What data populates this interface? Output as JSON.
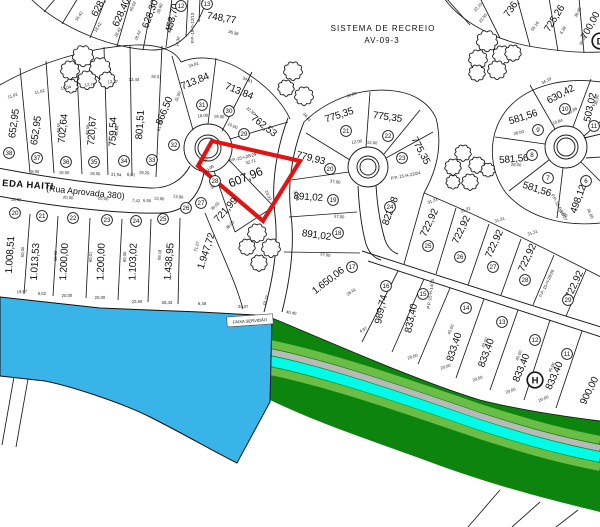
{
  "map": {
    "title": "Planta de loteamento (cadastral plat)",
    "colors": {
      "water": "#39b4e8",
      "band_dark": "#0d840d",
      "band_light": "#6abe45",
      "band_gray": "#b9b9b9",
      "band_cyan": "#00fce8",
      "highlight": "#e11414",
      "line": "#1a1a1a"
    },
    "annotations": {
      "recreation_line1": "SISTEMA DE RECREIO",
      "recreation_line2": "AV-09-3",
      "servidao_label": "FAIXA SERVIDÃO",
      "street_name": "EDA HAITI",
      "street_suffix": "(Rua Aprovada 380)"
    },
    "highlight": {
      "lot_number": "28",
      "lot_area": "607,96",
      "points": "212,141 300,161 263,221 198,166"
    },
    "area_labels": [
      [
        "628,",
        101,
        9,
        -62,
        10
      ],
      [
        "628,40",
        124,
        14,
        -66,
        10
      ],
      [
        "628,30",
        153,
        15,
        -70,
        10
      ],
      [
        "453,70",
        175,
        19,
        -76,
        10
      ],
      [
        "748,77",
        221,
        21,
        10,
        10
      ],
      [
        "736,",
        514,
        10,
        -55,
        10
      ],
      [
        "725,26",
        557,
        20,
        -58,
        10
      ],
      [
        "700,00",
        593,
        27,
        -62,
        10
      ],
      [
        "652,95",
        17,
        124,
        -82,
        10
      ],
      [
        "652,95",
        39,
        131,
        -82,
        10
      ],
      [
        "702,64",
        66,
        129,
        -84,
        10
      ],
      [
        "720,67",
        95,
        131,
        -86,
        10
      ],
      [
        "759,54",
        116,
        132,
        -88,
        10
      ],
      [
        "801,51",
        143,
        125,
        -86,
        10
      ],
      [
        "866,50",
        167,
        112,
        -68,
        10
      ],
      [
        "713,84",
        196,
        84,
        -22,
        10
      ],
      [
        "713,84",
        238,
        94,
        22,
        10
      ],
      [
        "762,53",
        262,
        128,
        38,
        10
      ],
      [
        "607,96",
        247,
        181,
        -22,
        12
      ],
      [
        "721,99",
        228,
        212,
        -48,
        10
      ],
      [
        "1.008,51",
        13,
        255,
        -86,
        10
      ],
      [
        "1.013,53",
        38,
        262,
        -86,
        10
      ],
      [
        "1.200,00",
        67,
        262,
        -87,
        10
      ],
      [
        "1.200,00",
        104,
        262,
        -88,
        10
      ],
      [
        "1.103,02",
        136,
        262,
        -88,
        10
      ],
      [
        "1.438,95",
        172,
        262,
        -85,
        10
      ],
      [
        "1.947,72",
        209,
        252,
        -72,
        10
      ],
      [
        "775,35",
        340,
        118,
        -18,
        10
      ],
      [
        "775,35",
        387,
        120,
        8,
        10
      ],
      [
        "775,35",
        418,
        152,
        62,
        10
      ],
      [
        "779,93",
        310,
        161,
        14,
        10
      ],
      [
        "891,02",
        308,
        200,
        4,
        10
      ],
      [
        "891,02",
        316,
        238,
        8,
        10
      ],
      [
        "822,08",
        393,
        212,
        -70,
        10
      ],
      [
        "1.650,06",
        330,
        283,
        -38,
        10
      ],
      [
        "989,74",
        384,
        310,
        -78,
        10
      ],
      [
        "833,40",
        414,
        319,
        -78,
        10
      ],
      [
        "833,40",
        457,
        348,
        -72,
        10
      ],
      [
        "833,40",
        489,
        354,
        -70,
        10
      ],
      [
        "833,40",
        524,
        369,
        -68,
        10
      ],
      [
        "833,40",
        557,
        377,
        -66,
        10
      ],
      [
        "900,00",
        592,
        392,
        -64,
        10
      ],
      [
        "722,92",
        432,
        224,
        -65,
        10
      ],
      [
        "722,92",
        464,
        231,
        -65,
        10
      ],
      [
        "722,92",
        497,
        245,
        -65,
        10
      ],
      [
        "722,92",
        530,
        259,
        -65,
        10
      ],
      [
        "722,92",
        577,
        286,
        -65,
        10
      ],
      [
        "630,42",
        562,
        97,
        -28,
        10
      ],
      [
        "581,56",
        524,
        120,
        -18,
        10
      ],
      [
        "503,02",
        593,
        108,
        -78,
        10
      ],
      [
        "581,56",
        514,
        162,
        -5,
        10
      ],
      [
        "581,56",
        536,
        192,
        18,
        10
      ],
      [
        "498,12",
        581,
        200,
        -70,
        10
      ]
    ],
    "lot_numbers": [
      [
        "12",
        181,
        6
      ],
      [
        "13",
        207,
        4
      ],
      [
        "38",
        9,
        153
      ],
      [
        "37",
        37,
        158
      ],
      [
        "36",
        66,
        162
      ],
      [
        "35",
        94,
        162
      ],
      [
        "34",
        124,
        161
      ],
      [
        "33",
        152,
        160
      ],
      [
        "32",
        174,
        145
      ],
      [
        "31",
        202,
        105
      ],
      [
        "30",
        229,
        111
      ],
      [
        "29",
        244,
        134
      ],
      [
        "28",
        215,
        181
      ],
      [
        "27",
        201,
        203
      ],
      [
        "20",
        15,
        213
      ],
      [
        "21",
        42,
        216
      ],
      [
        "22",
        73,
        218
      ],
      [
        "23",
        107,
        220
      ],
      [
        "24",
        136,
        221
      ],
      [
        "25",
        163,
        219
      ],
      [
        "26",
        186,
        208
      ],
      [
        "21",
        346,
        131
      ],
      [
        "22",
        388,
        136
      ],
      [
        "23",
        402,
        158
      ],
      [
        "20",
        330,
        169
      ],
      [
        "19",
        333,
        200
      ],
      [
        "18",
        338,
        233
      ],
      [
        "24",
        390,
        207
      ],
      [
        "17",
        352,
        267
      ],
      [
        "16",
        386,
        286
      ],
      [
        "15",
        423,
        294
      ],
      [
        "25",
        428,
        246
      ],
      [
        "26",
        460,
        257
      ],
      [
        "27",
        493,
        267
      ],
      [
        "28",
        525,
        280
      ],
      [
        "29",
        568,
        300
      ],
      [
        "14",
        466,
        308
      ],
      [
        "13",
        502,
        322
      ],
      [
        "12",
        535,
        340
      ],
      [
        "11",
        567,
        354
      ],
      [
        "10",
        565,
        109
      ],
      [
        "9",
        538,
        130
      ],
      [
        "11",
        594,
        126
      ],
      [
        "8",
        532,
        155
      ],
      [
        "7",
        548,
        178
      ],
      [
        "6",
        586,
        181
      ]
    ],
    "marker_letters": [
      [
        "H",
        535,
        380
      ],
      [
        "D",
        600,
        41
      ]
    ],
    "reference_labels": [
      [
        "P.P.-15-G-12/13",
        194,
        28,
        -90
      ],
      [
        "P.P.-15-I-28/29",
        243,
        159,
        -14
      ],
      [
        "P.P.-15-H-23/24",
        406,
        177,
        -11
      ],
      [
        "P.P.-15-H-14/15",
        432,
        294,
        -82
      ],
      [
        "P.P.-15-H-28/29",
        548,
        284,
        -65
      ],
      [
        "P.P.-15-F-06/07",
        558,
        208,
        62
      ]
    ],
    "dimension_labels": [
      [
        "16,42",
        80,
        17,
        -55
      ],
      [
        "18,42",
        99,
        28,
        -58
      ],
      [
        "18,42",
        119,
        33,
        -62
      ],
      [
        "18,42",
        139,
        36,
        -66
      ],
      [
        "14,30",
        179,
        42,
        -80
      ],
      [
        "33,48",
        172,
        24,
        -82
      ],
      [
        "40,02",
        134,
        7,
        -64
      ],
      [
        "39,80",
        161,
        9,
        -70
      ],
      [
        "36,38",
        233,
        34,
        16
      ],
      [
        "22,10",
        479,
        8,
        -48
      ],
      [
        "22,55",
        484,
        19,
        -50
      ],
      [
        "55,16",
        536,
        27,
        -54
      ],
      [
        "8,38",
        564,
        31,
        -58
      ],
      [
        "36,00",
        579,
        13,
        -62
      ],
      [
        "30,05",
        584,
        41,
        -64
      ],
      [
        "11,02",
        13,
        97,
        -18
      ],
      [
        "11,02",
        40,
        93,
        -14
      ],
      [
        "13,04",
        66,
        89,
        -10
      ],
      [
        "12,74",
        90,
        86,
        -6
      ],
      [
        "12,27",
        113,
        83,
        -3
      ],
      [
        "12,44",
        134,
        81,
        0
      ],
      [
        "18,01",
        156,
        78,
        6
      ],
      [
        "34,81",
        194,
        66,
        -18
      ],
      [
        "34,81",
        247,
        81,
        22
      ],
      [
        "32,50",
        179,
        97,
        -70
      ],
      [
        "32,50",
        250,
        112,
        40
      ],
      [
        "36,81",
        306,
        118,
        52
      ],
      [
        "61,18",
        161,
        126,
        -78
      ],
      [
        "18,00",
        203,
        117,
        -6
      ],
      [
        "19,00",
        219,
        118,
        4
      ],
      [
        "10,00",
        232,
        127,
        24
      ],
      [
        "18,00",
        34,
        173,
        3
      ],
      [
        "18,00",
        64,
        174,
        3
      ],
      [
        "18,00",
        95,
        175,
        4
      ],
      [
        "31,94",
        116,
        176,
        4
      ],
      [
        "6,01",
        131,
        176,
        4
      ],
      [
        "18,29",
        144,
        174,
        6
      ],
      [
        "49,55",
        60,
        128,
        -84
      ],
      [
        "49,58",
        89,
        130,
        -85
      ],
      [
        "48,68",
        118,
        131,
        -86
      ],
      [
        "13,00",
        204,
        163,
        -42
      ],
      [
        "39,00",
        210,
        170,
        -38
      ],
      [
        "38,00",
        216,
        186,
        -38
      ],
      [
        "32,71",
        251,
        163,
        -14
      ],
      [
        "23,32",
        267,
        196,
        64
      ],
      [
        "37,44",
        295,
        196,
        74
      ],
      [
        "39,00",
        216,
        207,
        -44
      ],
      [
        "38,00",
        231,
        226,
        -46
      ],
      [
        "13,62",
        16,
        201,
        3
      ],
      [
        "20,00",
        68,
        199,
        4
      ],
      [
        "20,00",
        103,
        200,
        4
      ],
      [
        "7,42",
        136,
        202,
        5
      ],
      [
        "6,50",
        147,
        202,
        5
      ],
      [
        "13,00",
        159,
        200,
        5
      ],
      [
        "13,00",
        178,
        198,
        7
      ],
      [
        "19,97",
        22,
        293,
        -3
      ],
      [
        "0,52",
        42,
        295,
        -2
      ],
      [
        "20,00",
        67,
        297,
        -2
      ],
      [
        "20,00",
        100,
        299,
        -2
      ],
      [
        "22,60",
        137,
        303,
        -1
      ],
      [
        "26,43",
        167,
        304,
        0
      ],
      [
        "6,38",
        202,
        305,
        2
      ],
      [
        "34,07",
        243,
        308,
        3
      ],
      [
        "10,77",
        267,
        301,
        -70
      ],
      [
        "40,40",
        291,
        314,
        10
      ],
      [
        "60,00",
        24,
        252,
        -87
      ],
      [
        "60,00",
        57,
        256,
        -88
      ],
      [
        "60,01",
        92,
        257,
        -88
      ],
      [
        "60,00",
        126,
        257,
        -88
      ],
      [
        "69,18",
        161,
        255,
        -85
      ],
      [
        "71,27",
        198,
        247,
        -74
      ],
      [
        "30,89",
        352,
        96,
        -20
      ],
      [
        "12,00",
        357,
        143,
        -8
      ],
      [
        "12,00",
        372,
        144,
        6
      ],
      [
        "37,00",
        335,
        183,
        8
      ],
      [
        "37,00",
        339,
        218,
        5
      ],
      [
        "37,00",
        325,
        256,
        10
      ],
      [
        "31,31",
        433,
        202,
        -22
      ],
      [
        "31,31",
        466,
        211,
        -20
      ],
      [
        "31,31",
        500,
        221,
        -18
      ],
      [
        "31,31",
        533,
        234,
        -18
      ],
      [
        "28,61",
        352,
        293,
        -35
      ],
      [
        "4,97",
        364,
        331,
        -30
      ],
      [
        "20,00",
        413,
        358,
        -18
      ],
      [
        "20,00",
        446,
        368,
        -18
      ],
      [
        "20,00",
        478,
        380,
        -20
      ],
      [
        "20,00",
        511,
        392,
        -20
      ],
      [
        "20,00",
        544,
        400,
        -22
      ],
      [
        "40,00",
        452,
        330,
        -68
      ],
      [
        "40,00",
        486,
        343,
        -68
      ],
      [
        "40,00",
        520,
        356,
        -68
      ],
      [
        "40,00",
        553,
        368,
        -66
      ],
      [
        "34,19",
        547,
        82,
        -28
      ],
      [
        "36,00",
        598,
        100,
        -78
      ],
      [
        "10,84",
        558,
        123,
        -18
      ],
      [
        "28,00",
        519,
        134,
        -12
      ],
      [
        "28,00",
        516,
        166,
        6
      ],
      [
        "15,00",
        562,
        214,
        40
      ],
      [
        "35,00",
        589,
        214,
        68
      ],
      [
        "10,88",
        573,
        112,
        -30
      ]
    ],
    "trees": [
      [
        83,
        56,
        9
      ],
      [
        70,
        70,
        8
      ],
      [
        100,
        68,
        9
      ],
      [
        87,
        80,
        8
      ],
      [
        71,
        86,
        6
      ],
      [
        107,
        80,
        7
      ],
      [
        293,
        71,
        8
      ],
      [
        286,
        88,
        7
      ],
      [
        304,
        96,
        8
      ],
      [
        487,
        41,
        9
      ],
      [
        478,
        59,
        8
      ],
      [
        502,
        55,
        8
      ],
      [
        513,
        53,
        7
      ],
      [
        497,
        70,
        8
      ],
      [
        477,
        73,
        7
      ],
      [
        463,
        153,
        7
      ],
      [
        453,
        167,
        7
      ],
      [
        477,
        165,
        7
      ],
      [
        488,
        170,
        6
      ],
      [
        453,
        182,
        6
      ],
      [
        470,
        182,
        7
      ],
      [
        257,
        233,
        8
      ],
      [
        247,
        247,
        7
      ],
      [
        271,
        248,
        8
      ],
      [
        259,
        263,
        7
      ]
    ]
  }
}
